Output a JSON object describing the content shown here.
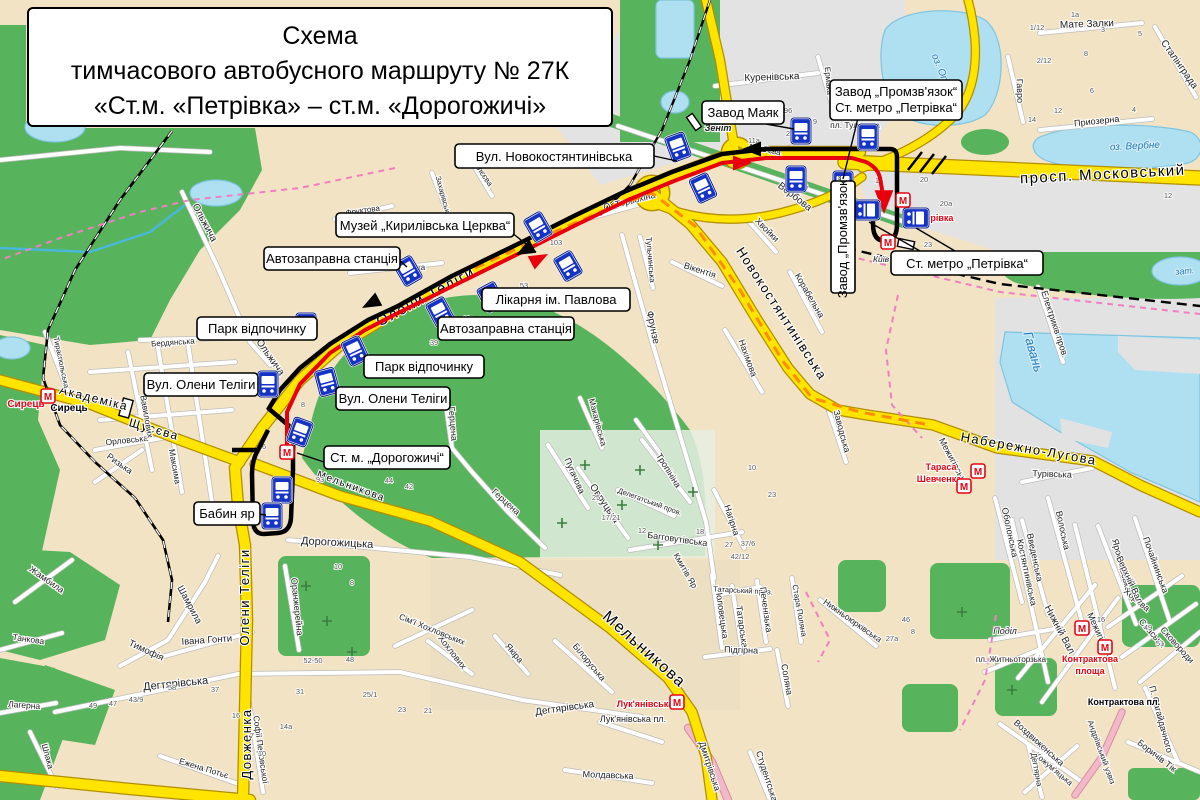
{
  "title": {
    "line1": "Схема",
    "line2": "тимчасового автобусного маршруту № 27К",
    "line3": "«Ст.м. «Петрівка» – ст.м. «Дорогожичі»"
  },
  "colors": {
    "route_black": "#000000",
    "route_red": "#e8000c",
    "road_yellow": "#ffe400",
    "road_casing": "#b28e00",
    "water": "#aee0f2",
    "park_green": "#58b45c",
    "block_beige": "#f2e3c4",
    "block_gray": "#e3e3e3",
    "bus_icon_blue": "#1533c5",
    "metro_red": "#e30613",
    "boundary_pink": "#ef7fc0",
    "aux_orange": "#ff8c00"
  },
  "callouts": {
    "novokost": "Вул. Новокостянтинівська",
    "muzei": "Музей „Кирилівська Церква“",
    "azs": "Автозаправна станція",
    "park": "Парк відпочинку",
    "likarnia": "Лікарня ім. Павлова",
    "telihy": "Вул. Олени Теліги",
    "dorohozhychi": "Ст. м. „Дорогожичі“",
    "babynyar": "Бабин яр",
    "maiak": "Завод Маяк",
    "prom_line1": "Завод „Промзв'язок“",
    "prom_line2": "Ст. метро „Петрівка“",
    "petrivka": "Ст. метро „Петрівка“",
    "prom_vert": "Завод „Промзв'язок“"
  },
  "map": {
    "street_labels": [
      [
        "просп. Московський",
        1103,
        179,
        -3,
        15,
        "rd"
      ],
      [
        "Олени Теліги",
        428,
        301,
        -28,
        15,
        "rd"
      ],
      [
        "Олени Теліги",
        249,
        597,
        -90,
        13,
        "rd"
      ],
      [
        "Довженка",
        251,
        744,
        -90,
        13,
        "rd"
      ],
      [
        "Мельникова",
        641,
        653,
        42,
        16,
        "rd"
      ],
      [
        "Мельникова",
        350,
        489,
        20,
        10,
        "rd"
      ],
      [
        "Новокостянтинівська",
        778,
        316,
        57,
        13,
        "rd"
      ],
      [
        "Набережно-Лугова",
        1028,
        453,
        10,
        13,
        "rd"
      ],
      [
        "Академіка",
        93,
        402,
        14,
        12,
        "rd"
      ],
      [
        "Щусєва",
        153,
        433,
        16,
        12,
        "rd"
      ],
      [
        "Дегтярівська",
        176,
        687,
        -6,
        11
      ],
      [
        "Дегтярівська",
        565,
        711,
        -8,
        10
      ],
      [
        "Дорогожицька",
        337,
        546,
        3,
        11
      ],
      [
        "Куренівська",
        772,
        80,
        -2,
        10
      ],
      [
        "Вербова",
        793,
        199,
        38,
        10
      ],
      [
        "Аляб'єва",
        764,
        152,
        12,
        8
      ],
      [
        "Ермака",
        826,
        81,
        85,
        8
      ],
      [
        "Мате Залки",
        1087,
        27,
        -2,
        10
      ],
      [
        "Приозерна",
        1097,
        124,
        -6,
        9
      ],
      [
        "Гавро",
        1017,
        91,
        88,
        9
      ],
      [
        "Сталінграда",
        1177,
        66,
        55,
        10
      ],
      [
        "О. Терьохіна",
        630,
        204,
        -14,
        9
      ],
      [
        "Фрунзе",
        650,
        328,
        78,
        10
      ],
      [
        "Нахімова",
        745,
        359,
        70,
        9
      ],
      [
        "Вікентія",
        699,
        273,
        18,
        9
      ],
      [
        "Хвойки",
        765,
        232,
        45,
        9
      ],
      [
        "Тульчинська",
        648,
        260,
        85,
        8
      ],
      [
        "Корабельна",
        807,
        297,
        60,
        9
      ],
      [
        "Заводська",
        839,
        432,
        75,
        9
      ],
      [
        "Електриків пров.",
        1052,
        325,
        72,
        9
      ],
      [
        "Турівська",
        1052,
        477,
        2,
        9
      ],
      [
        "Оболонська",
        1007,
        533,
        78,
        9
      ],
      [
        "Введенська",
        1032,
        558,
        78,
        9
      ],
      [
        "Волоська",
        1060,
        531,
        78,
        9
      ],
      [
        "Почайнинська",
        1153,
        566,
        70,
        9
      ],
      [
        "Ярославська",
        1119,
        566,
        75,
        9
      ],
      [
        "Костянтинівська",
        1024,
        573,
        78,
        9
      ],
      [
        "Межигірська",
        951,
        463,
        62,
        9
      ],
      [
        "Межигірська",
        1098,
        638,
        65,
        9
      ],
      [
        "Хорива",
        1135,
        602,
        40,
        9
      ],
      [
        "Спаська",
        1150,
        635,
        48,
        9
      ],
      [
        "Сковороди",
        1175,
        647,
        48,
        9
      ],
      [
        "Нижній Вал",
        1057,
        631,
        62,
        10
      ],
      [
        "Верхній Вал",
        1127,
        581,
        65,
        9
      ],
      [
        "П. Сагайдачного",
        1158,
        720,
        75,
        9
      ],
      [
        "Боричів Тік",
        1155,
        758,
        38,
        9
      ],
      [
        "Воздвиженська",
        1037,
        745,
        42,
        9
      ],
      [
        "Кожум'яцька",
        1052,
        771,
        40,
        8
      ],
      [
        "Дегтярна",
        1034,
        770,
        80,
        8
      ],
      [
        "Андріївський узвіз",
        1099,
        753,
        70,
        8
      ],
      [
        "пл. Житньоторзька",
        1011,
        662,
        0,
        8
      ],
      [
        "Поділ",
        1005,
        634,
        0,
        9,
        "it"
      ],
      [
        "Контрактова пл.",
        1124,
        705,
        0,
        9,
        "b"
      ],
      [
        "Лук'янівська пл.",
        633,
        722,
        0,
        9
      ],
      [
        "Половецька",
        719,
        614,
        82,
        9
      ],
      [
        "Татарська",
        739,
        627,
        82,
        9
      ],
      [
        "Татарський пров.",
        743,
        593,
        3,
        7.5
      ],
      [
        "Підгірна",
        741,
        653,
        2,
        9
      ],
      [
        "Печенізька",
        763,
        610,
        82,
        9
      ],
      [
        "Соляна",
        784,
        680,
        80,
        9
      ],
      [
        "Стара Поляна",
        797,
        611,
        80,
        8
      ],
      [
        "Нижньоюрківська",
        851,
        623,
        35,
        8.5
      ],
      [
        "Дмитрівська",
        707,
        767,
        72,
        9
      ],
      [
        "Студентська",
        764,
        777,
        72,
        9
      ],
      [
        "Якіра",
        512,
        655,
        50,
        9
      ],
      [
        "Білоруська",
        587,
        664,
        50,
        9
      ],
      [
        "Хохлових",
        450,
        654,
        52,
        9
      ],
      [
        "Молдавська",
        608,
        778,
        2,
        9
      ],
      [
        "Кмитів Яр",
        683,
        572,
        60,
        8.5
      ],
      [
        "Герцена",
        450,
        424,
        85,
        9
      ],
      [
        "Герцена",
        504,
        504,
        42,
        9
      ],
      [
        "Пугачова",
        572,
        477,
        66,
        9
      ],
      [
        "Овруцька",
        602,
        505,
        56,
        10
      ],
      [
        "Тропініна",
        666,
        472,
        58,
        9
      ],
      [
        "Делегатський пров.",
        649,
        504,
        20,
        7.5
      ],
      [
        "Багговутівська",
        677,
        542,
        8,
        9
      ],
      [
        "Нагірна",
        729,
        521,
        72,
        9
      ],
      [
        "Макарівська",
        595,
        423,
        75,
        8.5
      ],
      [
        "Ольжича",
        202,
        224,
        62,
        10
      ],
      [
        "Ольжича",
        268,
        359,
        55,
        10
      ],
      [
        "Орловська",
        127,
        443,
        -6,
        8.5
      ],
      [
        "Ризька",
        118,
        466,
        35,
        9
      ],
      [
        "Тираспольська",
        59,
        363,
        78,
        7.5
      ],
      [
        "Вавилових",
        144,
        417,
        80,
        8.5
      ],
      [
        "Максима",
        172,
        467,
        80,
        8.5
      ],
      [
        "Бердянська",
        173,
        345,
        -4,
        8
      ],
      [
        "Тимофія",
        145,
        653,
        25,
        9.5
      ],
      [
        "Шамрила",
        187,
        606,
        62,
        9.5
      ],
      [
        "Івана Гонти",
        207,
        643,
        -4,
        9.5
      ],
      [
        "Жамбила",
        45,
        582,
        35,
        9
      ],
      [
        "Танкова",
        28,
        642,
        8,
        8.5
      ],
      [
        "Лагерна",
        24,
        708,
        4,
        8.5
      ],
      [
        "Оранжерейна",
        294,
        607,
        84,
        9
      ],
      [
        "Сім'ї Хохловських",
        431,
        632,
        22,
        8.5
      ],
      [
        "Софії Перовської",
        258,
        750,
        82,
        8.5
      ],
      [
        "Ежена Потьє",
        203,
        771,
        17,
        8.5
      ],
      [
        "Шпака",
        45,
        757,
        75,
        8.5
      ],
      [
        "Петропавлівська",
        394,
        269,
        2,
        8
      ],
      [
        "Фруктова",
        363,
        213,
        -8,
        8
      ],
      [
        "Рилєєва",
        480,
        174,
        55,
        8
      ],
      [
        "Захарівська",
        441,
        197,
        75,
        7.5
      ],
      [
        "Гавань",
        1029,
        353,
        74,
        13,
        "w"
      ],
      [
        "оз. Вербне",
        1135,
        149,
        -3,
        10,
        "w"
      ],
      [
        "оз. Опечень",
        942,
        81,
        68,
        10,
        "w"
      ],
      [
        "зат.",
        1185,
        274,
        -5,
        9,
        "w"
      ],
      [
        "Сирець",
        26,
        407,
        0,
        10,
        "r"
      ],
      [
        "Тараса",
        941,
        470,
        0,
        9,
        "r"
      ],
      [
        "Шевченка",
        939,
        482,
        0,
        9,
        "r"
      ],
      [
        "Контрактова",
        1090,
        662,
        0,
        9,
        "r"
      ],
      [
        "площа",
        1090,
        674,
        0,
        9,
        "r"
      ],
      [
        "Лук'янівська",
        645,
        707,
        0,
        9,
        "r"
      ],
      [
        "Петрівка",
        934,
        221,
        0,
        9,
        "r"
      ],
      [
        "Сирець",
        69,
        411,
        0,
        10,
        "b"
      ],
      [
        "Київ",
        881,
        262,
        0,
        8.5,
        "it"
      ],
      [
        "Зеніт",
        718,
        131,
        0,
        9,
        "bi"
      ],
      [
        "пл. Тульська",
        855,
        128,
        0,
        8.5
      ]
    ],
    "house_numbers": [
      [
        "21",
        790,
        136
      ],
      [
        "11а",
        754,
        143
      ],
      [
        "196",
        786,
        113
      ],
      [
        "9",
        815,
        124
      ],
      [
        "6",
        806,
        189
      ],
      [
        "16",
        879,
        183
      ],
      [
        "20",
        924,
        182
      ],
      [
        "20а",
        946,
        206
      ],
      [
        "23",
        928,
        247
      ],
      [
        "12",
        1168,
        198
      ],
      [
        "1/12",
        1037,
        30
      ],
      [
        "1а",
        1075,
        17
      ],
      [
        "3",
        1103,
        32
      ],
      [
        "5",
        1140,
        36
      ],
      [
        "8",
        1086,
        56
      ],
      [
        "2/12",
        1044,
        63
      ],
      [
        "4",
        1134,
        112
      ],
      [
        "6",
        1092,
        93
      ],
      [
        "12",
        1058,
        113
      ],
      [
        "14",
        1032,
        122
      ],
      [
        "103",
        556,
        245
      ],
      [
        "53",
        524,
        288
      ],
      [
        "49",
        502,
        301
      ],
      [
        "43а",
        468,
        321
      ],
      [
        "39",
        434,
        345
      ],
      [
        "35",
        404,
        361
      ],
      [
        "8",
        303,
        407
      ],
      [
        "16",
        262,
        449
      ],
      [
        "93",
        320,
        482
      ],
      [
        "44",
        389,
        483
      ],
      [
        "42",
        409,
        489
      ],
      [
        "10",
        338,
        569
      ],
      [
        "8",
        352,
        585
      ],
      [
        "17/21",
        611,
        520
      ],
      [
        "25",
        596,
        500
      ],
      [
        "12",
        642,
        533
      ],
      [
        "18",
        700,
        534
      ],
      [
        "27",
        729,
        547
      ],
      [
        "37/6",
        748,
        546
      ],
      [
        "42/12",
        740,
        559
      ],
      [
        "10",
        752,
        470
      ],
      [
        "23",
        772,
        497
      ],
      [
        "52-50",
        313,
        663
      ],
      [
        "48",
        350,
        662
      ],
      [
        "31",
        300,
        694
      ],
      [
        "25/1",
        370,
        697
      ],
      [
        "23",
        402,
        712
      ],
      [
        "21",
        428,
        713
      ],
      [
        "37",
        215,
        692
      ],
      [
        "58",
        172,
        690
      ],
      [
        "49",
        93,
        708
      ],
      [
        "47",
        113,
        706
      ],
      [
        "43/9",
        136,
        702
      ],
      [
        "14а",
        286,
        729
      ],
      [
        "16",
        236,
        718
      ],
      [
        "7",
        252,
        738
      ],
      [
        "10",
        262,
        756
      ],
      [
        "46",
        906,
        622
      ],
      [
        "27а",
        892,
        641
      ],
      [
        "8",
        913,
        634
      ],
      [
        "49",
        1148,
        630
      ],
      [
        "51",
        1160,
        646
      ],
      [
        "16",
        1101,
        622
      ]
    ],
    "bus_stops": [
      [
        678,
        147,
        -20
      ],
      [
        801,
        131,
        0
      ],
      [
        868,
        137,
        0
      ],
      [
        703,
        188,
        -25
      ],
      [
        796,
        179,
        0
      ],
      [
        843,
        184,
        0
      ],
      [
        867,
        210,
        90
      ],
      [
        916,
        218,
        90
      ],
      [
        538,
        227,
        -30
      ],
      [
        568,
        266,
        -30
      ],
      [
        408,
        271,
        -30
      ],
      [
        491,
        297,
        -28
      ],
      [
        440,
        312,
        -28
      ],
      [
        355,
        351,
        -25
      ],
      [
        306,
        326,
        0
      ],
      [
        327,
        382,
        -15
      ],
      [
        268,
        384,
        0
      ],
      [
        300,
        432,
        20
      ],
      [
        282,
        490,
        0
      ],
      [
        272,
        516,
        0
      ]
    ],
    "metro_icons": [
      [
        48,
        396
      ],
      [
        287,
        452
      ],
      [
        903,
        200
      ],
      [
        888,
        242
      ],
      [
        978,
        471
      ],
      [
        964,
        486
      ],
      [
        1105,
        647
      ],
      [
        1082,
        628
      ],
      [
        677,
        702
      ]
    ],
    "crosses": [
      [
        585,
        465
      ],
      [
        622,
        505
      ],
      [
        658,
        545
      ],
      [
        693,
        492
      ],
      [
        562,
        523
      ],
      [
        640,
        470
      ],
      [
        306,
        586
      ],
      [
        327,
        621
      ],
      [
        352,
        652
      ],
      [
        1012,
        690
      ],
      [
        962,
        612
      ]
    ]
  }
}
